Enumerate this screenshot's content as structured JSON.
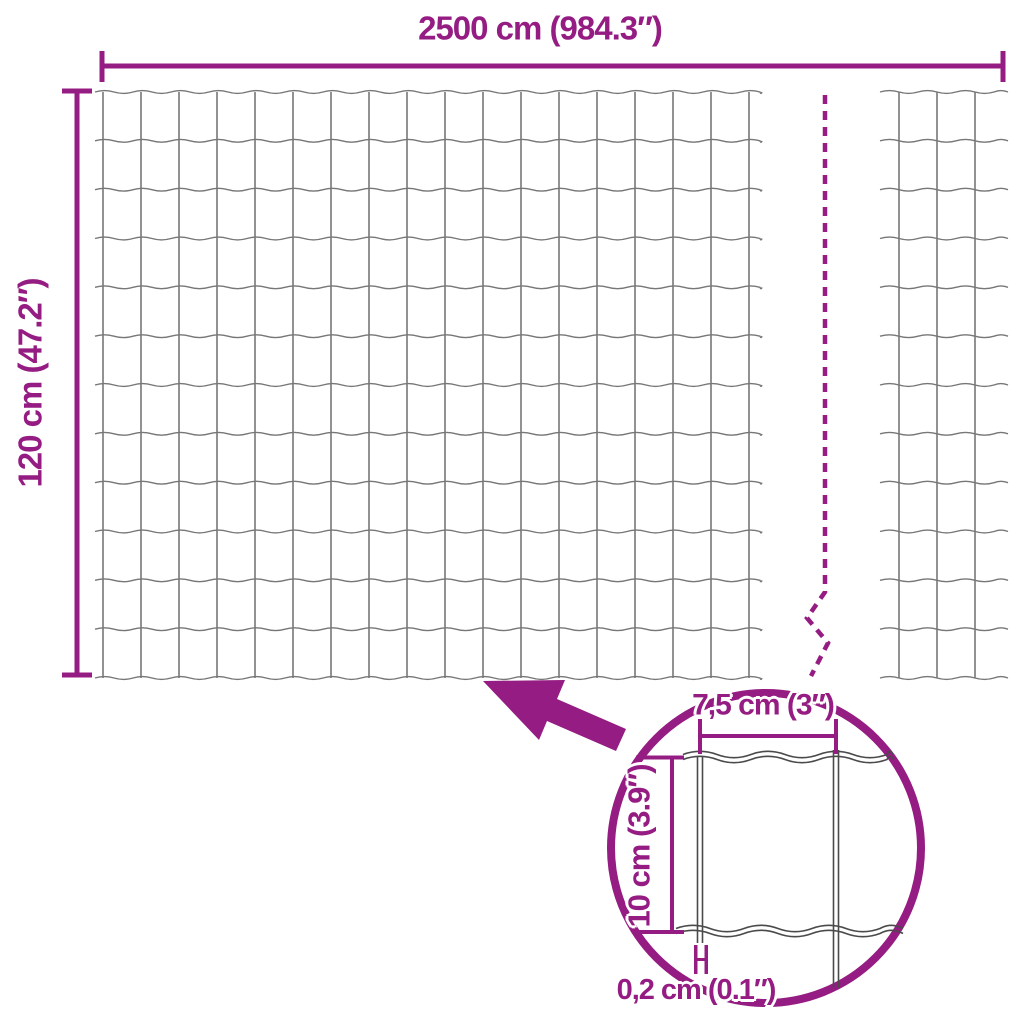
{
  "colors": {
    "accent": "#951C82",
    "wire": "#777777",
    "detail_wire": "#4a4a4a",
    "background": "#ffffff"
  },
  "labels": {
    "total_width": "2500 cm (984.3″)",
    "total_height": "120 cm (47.2″)",
    "mesh_width": "7,5 cm (3″)",
    "mesh_height": "10 cm (3.9″)",
    "wire_thickness": "0,2 cm (0.1″)"
  },
  "mesh": {
    "rows": 12,
    "columns_main": 17,
    "columns_right": 2,
    "horizontal_wires": 13,
    "vertical_wires_main": 18,
    "vertical_wires_right": 3
  }
}
